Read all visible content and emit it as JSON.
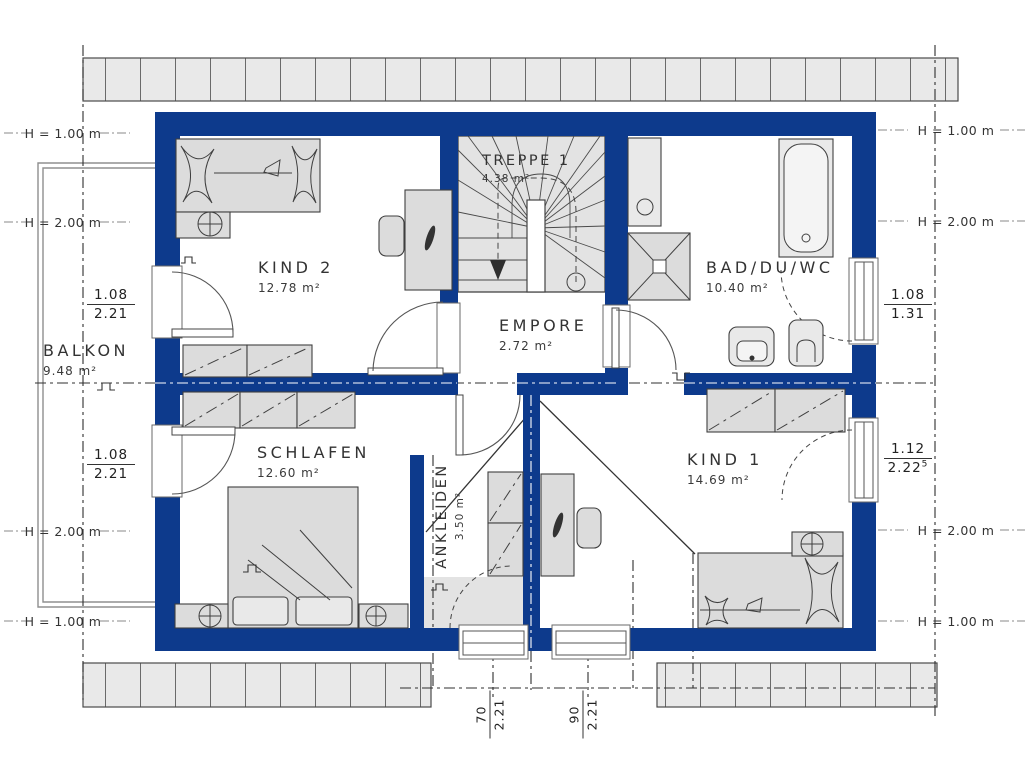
{
  "colors": {
    "wall": "#0d3a8c",
    "roof_fill": "#e9e9e9",
    "furniture_fill": "#dcdcdc",
    "floor": "#ffffff",
    "line": "#3c3c3c"
  },
  "rooms": [
    {
      "name": "BALKON",
      "area": "9.48 m²"
    },
    {
      "name": "KIND 2",
      "area": "12.78 m²"
    },
    {
      "name": "TREPPE 1",
      "area": "4.38 m²"
    },
    {
      "name": "BAD/DU/WC",
      "area": "10.40 m²"
    },
    {
      "name": "EMPORE",
      "area": "2.72 m²"
    },
    {
      "name": "SCHLAFEN",
      "area": "12.60 m²"
    },
    {
      "name": "ANKLEIDEN",
      "area": "3.50 m²"
    },
    {
      "name": "KIND 1",
      "area": "14.69 m²"
    }
  ],
  "height_markers": {
    "left": [
      "H = 1.00 m",
      "H = 2.00 m",
      "H = 2.00 m",
      "H = 1.00 m"
    ],
    "right": [
      "H = 1.00 m",
      "H = 2.00 m",
      "H = 2.00 m",
      "H = 1.00 m"
    ]
  },
  "window_dimensions": [
    {
      "id": "left-upper",
      "num": "1.08",
      "den": "2.21",
      "sup": ""
    },
    {
      "id": "left-lower",
      "num": "1.08",
      "den": "2.21",
      "sup": ""
    },
    {
      "id": "right-upper",
      "num": "1.08",
      "den": "1.31",
      "sup": ""
    },
    {
      "id": "right-lower",
      "num": "1.12",
      "den": "2.22",
      "sup": "5"
    },
    {
      "id": "bottom-left",
      "num": "70",
      "den": "2.21",
      "sup": ""
    },
    {
      "id": "bottom-right",
      "num": "90",
      "den": "2.21",
      "sup": ""
    }
  ]
}
